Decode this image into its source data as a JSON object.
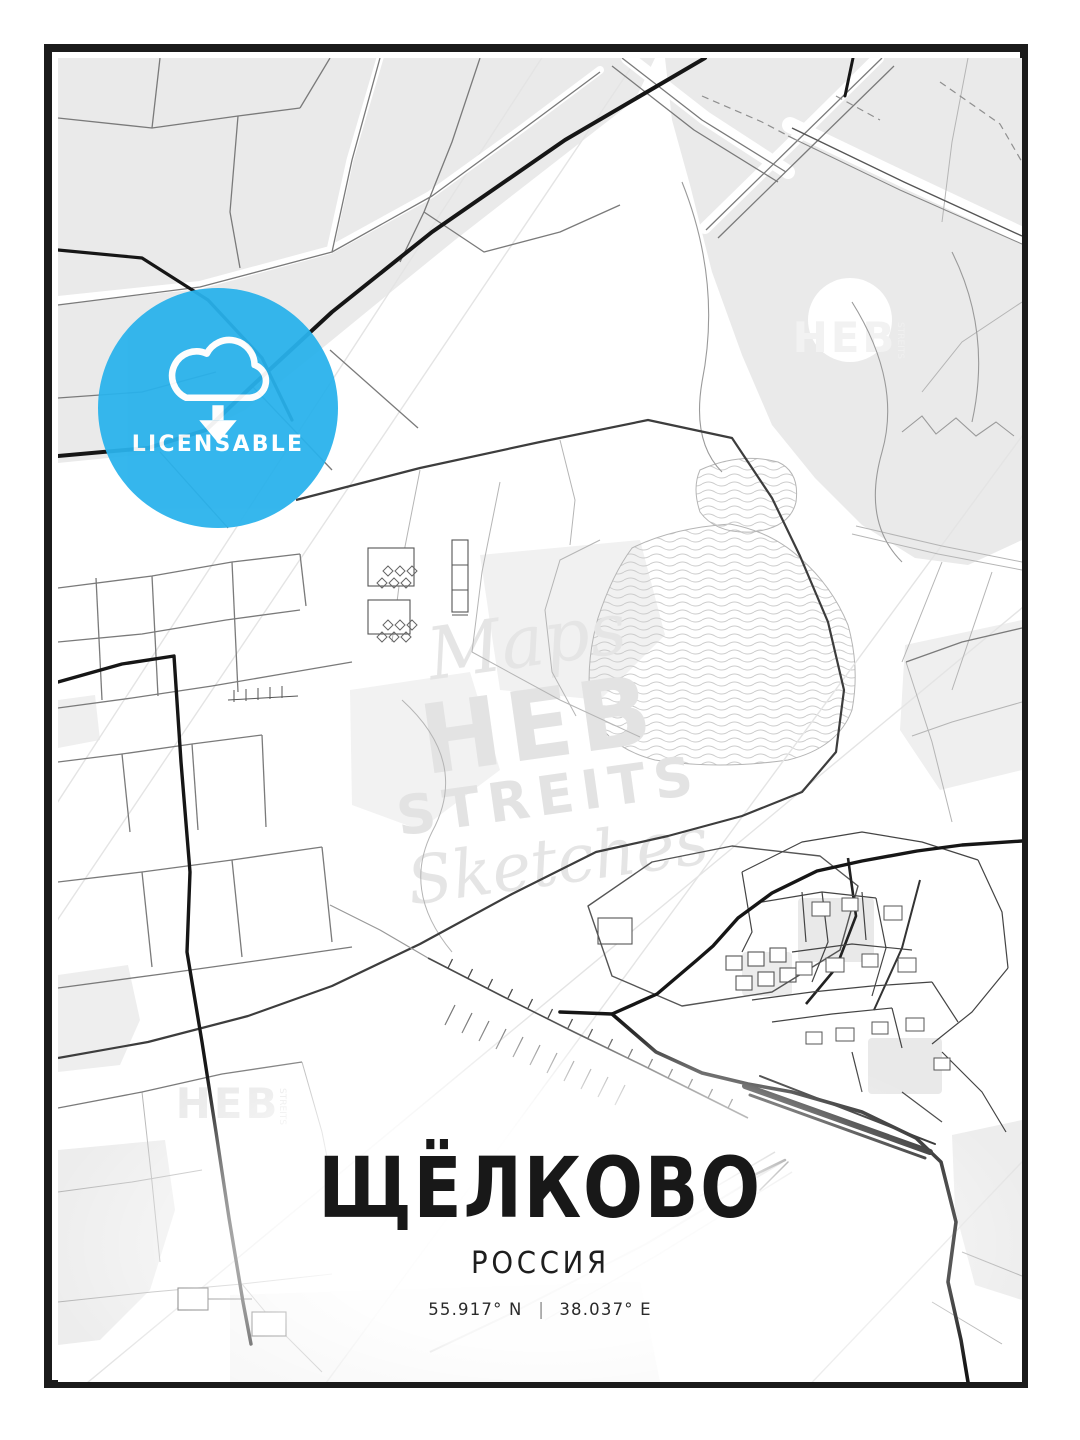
{
  "poster": {
    "title": "ЩЁЛКОВО",
    "country": "РОССИЯ",
    "coordinates": {
      "lat": "55.917° N",
      "separator": "|",
      "lon": "38.037° E"
    }
  },
  "badge": {
    "label": "LICENSABLE",
    "icon": "cloud-download-icon",
    "color": "#29b2ec"
  },
  "watermark": {
    "script_top": "Maps",
    "brand_top": "HEB",
    "brand_bottom": "STREITS",
    "script_bottom": "Sketches",
    "corner": "HEB",
    "corner_small": "STREITS"
  },
  "colors": {
    "badge_blue": "#29b2ec",
    "frame_black": "#1b1b1b",
    "road_major": "#161616",
    "road_medium": "#555555",
    "road_minor": "#7a7a7a",
    "road_faint": "#b5b5b5",
    "area_fill": "#eaeaea",
    "water_line": "#cccccc",
    "title_text": "#181818"
  }
}
